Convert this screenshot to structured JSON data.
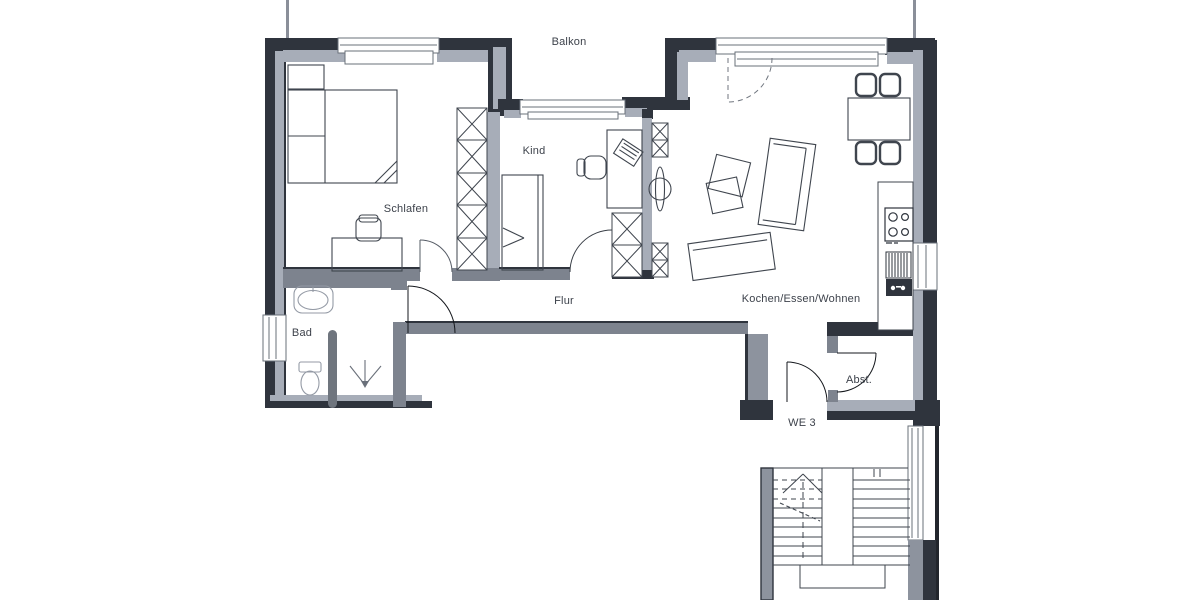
{
  "floorplan": {
    "type": "apartment-floor-plan",
    "labels": {
      "balkon": "Balkon",
      "kind": "Kind",
      "schlafen": "Schlafen",
      "bad": "Bad",
      "flur": "Flur",
      "wohnen": "Kochen/Essen/Wohnen",
      "abst": "Abst.",
      "we3": "WE 3"
    },
    "rooms": [
      {
        "name": "Balkon"
      },
      {
        "name": "Schlafen"
      },
      {
        "name": "Kind"
      },
      {
        "name": "Bad"
      },
      {
        "name": "Flur"
      },
      {
        "name": "Kochen/Essen/Wohnen"
      },
      {
        "name": "Abst."
      }
    ],
    "unit": "WE 3",
    "colors": {
      "wall_dark": "#2f343d",
      "wall_gray": "#a7adb8",
      "wall_mid": "#7d838e",
      "partition": "#6f757e",
      "furniture_line": "#3f454e",
      "fixture_line": "#949aa5",
      "background": "#ffffff",
      "text": "#3d424b"
    }
  }
}
